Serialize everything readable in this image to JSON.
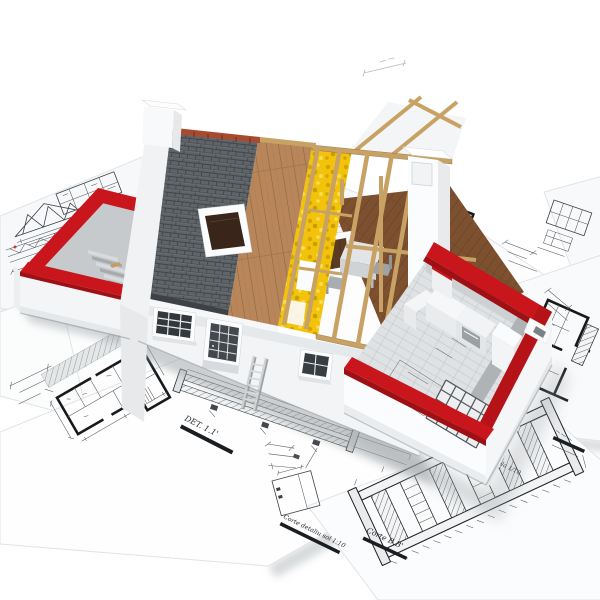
{
  "scene": {
    "type": "3d-architectural-render",
    "description": "Cutaway 3D model house with layered roof construction (slate, wood sheathing, yellow insulation, open timber frame) and red-capped unfinished walls, standing on scattered architectural blueprint sheets",
    "background": "#ffffff"
  },
  "palette": {
    "red_wall_cap": "#c9161c",
    "red_wall_dark": "#9e1013",
    "slate_roof": "#5f6468",
    "roof_ridge_tile": "#a84a30",
    "wood_sheathing": "#b8865a",
    "insulation_yellow": "#f2c30a",
    "attic_floor_wood": "#7d5130",
    "timber_frame": "#c8a264",
    "wall_white": "#fafbfc",
    "interior_gray": "#c3c7ca",
    "blueprint_ink": "#3c4147",
    "shadow_gray": "#aab0b3"
  },
  "blueprint_labels": {
    "det_11": "DET. 1.1'",
    "det_c": "DET. C.",
    "scala": "scala 1/10",
    "corte_bb": "Corte B.B'",
    "corte_detaliu": "Corte detaliu sol 1:10"
  }
}
